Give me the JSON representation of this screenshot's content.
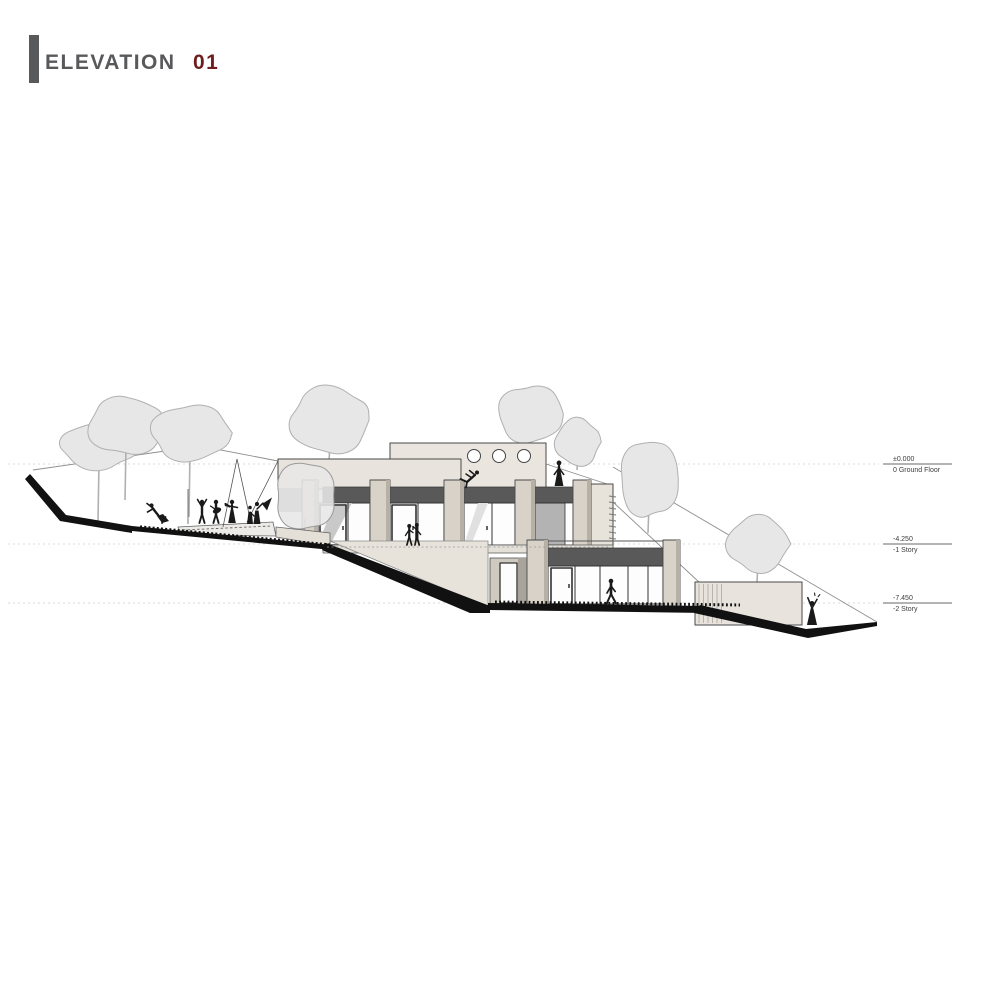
{
  "title": {
    "label": "ELEVATION",
    "number": "01"
  },
  "levels": [
    {
      "value": "±0.000",
      "name": "0 Ground Floor"
    },
    {
      "value": "-4.250",
      "name": "-1 Story"
    },
    {
      "value": "-7.450",
      "name": "-2 Story"
    }
  ],
  "colors": {
    "title_gray": "#58595b",
    "accent_red": "#6e1e1e",
    "ink": "#1a1a1a",
    "outline": "#4a4a4a",
    "fascia_gray": "#595959",
    "wall_beige": "#eae6df",
    "pier_beige": "#d8d2c8",
    "pier_shade": "#b7b1a5",
    "slab_beige": "#e4e0d8",
    "terrain_beige": "#e7e3db",
    "terrain_black": "#111111",
    "tree_fill": "#e7e7e7",
    "tree_line": "#b0b0b0",
    "glass_white": "#fdfdfd",
    "shadow_gray": "#c9c9c9"
  },
  "drawing": {
    "type": "architectural-elevation",
    "figures": [
      {
        "role": "figure-conductor"
      },
      {
        "role": "figure-performer-arms-raised"
      },
      {
        "role": "figure-guitarist"
      },
      {
        "role": "figure-violinist"
      },
      {
        "role": "figure-dancers"
      },
      {
        "role": "figure-roof-dancer"
      },
      {
        "role": "figure-roof-woman"
      },
      {
        "role": "figure-visitors-in-window"
      },
      {
        "role": "figure-walking-man"
      },
      {
        "role": "figure-celebrating-woman"
      }
    ]
  }
}
